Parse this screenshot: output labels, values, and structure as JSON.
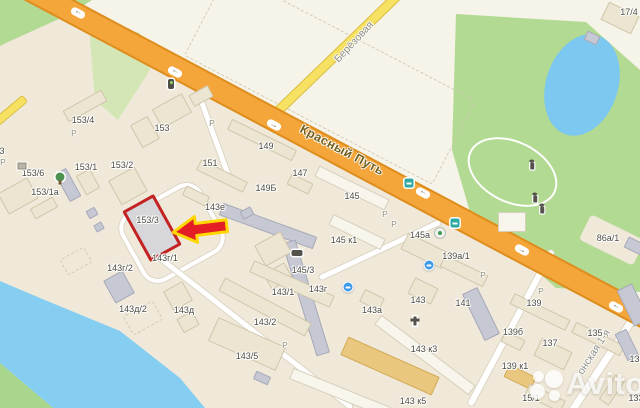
{
  "map": {
    "street_labels": [
      {
        "text": "Красный Путь",
        "x": 342,
        "y": 150,
        "angle": 28,
        "major": true
      },
      {
        "text": "Берёзовая",
        "x": 354,
        "y": 42,
        "angle": -47,
        "major": false
      },
      {
        "text": "онская 1-я",
        "x": 594,
        "y": 352,
        "angle": -57,
        "major": false
      }
    ],
    "target": {
      "label": "153/3"
    },
    "building_labels": [
      {
        "text": "153/4",
        "x": 83,
        "y": 120
      },
      {
        "text": "153",
        "x": 162,
        "y": 128
      },
      {
        "text": "153/6",
        "x": 33,
        "y": 173
      },
      {
        "text": "153/1",
        "x": 86,
        "y": 167
      },
      {
        "text": "153/2",
        "x": 122,
        "y": 165
      },
      {
        "text": "153/1а",
        "x": 45,
        "y": 192
      },
      {
        "text": "151",
        "x": 210,
        "y": 163
      },
      {
        "text": "149",
        "x": 266,
        "y": 146
      },
      {
        "text": "149Б",
        "x": 266,
        "y": 188
      },
      {
        "text": "147",
        "x": 300,
        "y": 173
      },
      {
        "text": "145",
        "x": 352,
        "y": 196
      },
      {
        "text": "143е",
        "x": 215,
        "y": 207
      },
      {
        "text": "145 к1",
        "x": 344,
        "y": 240
      },
      {
        "text": "145а",
        "x": 420,
        "y": 235
      },
      {
        "text": "139а/1",
        "x": 456,
        "y": 256
      },
      {
        "text": "86а/1",
        "x": 608,
        "y": 238
      },
      {
        "text": "17/4",
        "x": 629,
        "y": 12
      },
      {
        "text": "145/3",
        "x": 303,
        "y": 270
      },
      {
        "text": "143/1",
        "x": 283,
        "y": 292
      },
      {
        "text": "143г",
        "x": 318,
        "y": 289
      },
      {
        "text": "143г/1",
        "x": 165,
        "y": 258
      },
      {
        "text": "143г/2",
        "x": 120,
        "y": 268
      },
      {
        "text": "143д/2",
        "x": 133,
        "y": 309
      },
      {
        "text": "143д",
        "x": 184,
        "y": 310
      },
      {
        "text": "143/2",
        "x": 265,
        "y": 322
      },
      {
        "text": "143/5",
        "x": 247,
        "y": 356
      },
      {
        "text": "143а",
        "x": 372,
        "y": 310
      },
      {
        "text": "143",
        "x": 418,
        "y": 300
      },
      {
        "text": "141",
        "x": 463,
        "y": 303
      },
      {
        "text": "143 к3",
        "x": 424,
        "y": 349
      },
      {
        "text": "143 к5",
        "x": 413,
        "y": 401
      },
      {
        "text": "139",
        "x": 534,
        "y": 303
      },
      {
        "text": "139б",
        "x": 513,
        "y": 332
      },
      {
        "text": "135",
        "x": 595,
        "y": 333
      },
      {
        "text": "137",
        "x": 550,
        "y": 343
      },
      {
        "text": "139 к1",
        "x": 515,
        "y": 366
      },
      {
        "text": "15/1",
        "x": 531,
        "y": 398
      },
      {
        "text": "133",
        "x": 637,
        "y": 359
      },
      {
        "text": "133",
        "x": 636,
        "y": 398
      },
      {
        "text": "3",
        "x": 2,
        "y": 151
      }
    ],
    "parking_glyph": "Р",
    "parking_positions": [
      [
        74,
        133
      ],
      [
        3,
        162
      ],
      [
        212,
        123
      ],
      [
        385,
        214
      ],
      [
        394,
        224
      ],
      [
        483,
        275
      ],
      [
        285,
        345
      ],
      [
        541,
        291
      ]
    ],
    "road_arrows": [
      {
        "x": 78,
        "y": 13,
        "flip": true
      },
      {
        "x": 175,
        "y": 72,
        "flip": true
      },
      {
        "x": 274,
        "y": 125,
        "flip": false
      },
      {
        "x": 423,
        "y": 193,
        "flip": true
      },
      {
        "x": 522,
        "y": 250,
        "flip": false
      },
      {
        "x": 616,
        "y": 307,
        "flip": true
      }
    ],
    "pois": [
      {
        "name": "traffic-light-icon",
        "x": 171,
        "y": 84
      },
      {
        "name": "tree-icon",
        "x": 60,
        "y": 177
      },
      {
        "name": "kiosk-icon",
        "x": 22,
        "y": 166
      },
      {
        "name": "car-icon",
        "x": 297,
        "y": 253
      },
      {
        "name": "monument-icon",
        "x": 415,
        "y": 321
      },
      {
        "name": "fountain-icon",
        "x": 440,
        "y": 233
      },
      {
        "name": "transit-stop-icon",
        "x": 455,
        "y": 223
      },
      {
        "name": "transit-stop-icon",
        "x": 409,
        "y": 183
      },
      {
        "name": "shop-poi-icon",
        "x": 429,
        "y": 265
      },
      {
        "name": "shop-poi-icon",
        "x": 348,
        "y": 287
      },
      {
        "name": "statue-icon",
        "x": 535,
        "y": 199
      },
      {
        "name": "statue-icon",
        "x": 542,
        "y": 210
      },
      {
        "name": "statue-icon",
        "x": 532,
        "y": 166
      }
    ]
  },
  "watermark": {
    "text": "Avito"
  },
  "colors": {
    "road_major": "#f5a63b",
    "road_major_edge": "#dd8e1e",
    "road_minor": "#f6e163",
    "water": "#85cef2",
    "park": "#b2da92",
    "target_outline": "#c32222",
    "arrow_fill": "#e31e24",
    "arrow_outline": "#ffd600"
  }
}
